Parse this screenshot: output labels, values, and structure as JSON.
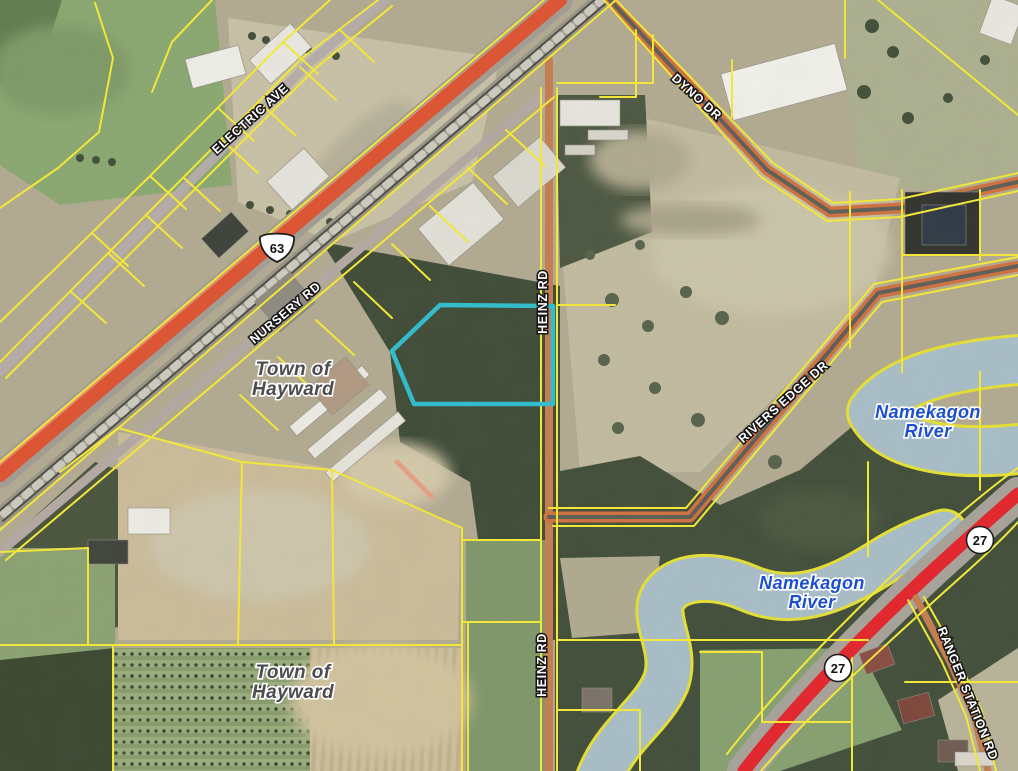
{
  "map": {
    "road_labels": [
      {
        "id": "electric-ave",
        "text": "ELECTRIC AVE"
      },
      {
        "id": "nursery-rd",
        "text": "NURSERY RD"
      },
      {
        "id": "dyno-dr",
        "text": "DYNO DR"
      },
      {
        "id": "heinz-rd-north",
        "text": "HEINZ RD"
      },
      {
        "id": "heinz-rd-south",
        "text": "HEINZ RD"
      },
      {
        "id": "rivers-edge-dr",
        "text": "RIVERS EDGE DR"
      },
      {
        "id": "ranger-station-rd",
        "text": "RANGER STATION RD"
      }
    ],
    "place_labels": [
      {
        "id": "town-of-hayward-north",
        "lines": [
          "Town of",
          "Hayward"
        ]
      },
      {
        "id": "town-of-hayward-south",
        "lines": [
          "Town of",
          "Hayward"
        ]
      }
    ],
    "water_labels": [
      {
        "id": "namekagon-river-upper",
        "lines": [
          "Namekagon",
          "River"
        ]
      },
      {
        "id": "namekagon-river-lower",
        "lines": [
          "Namekagon",
          "River"
        ]
      }
    ],
    "shields": [
      {
        "type": "us-route-shield",
        "number": "63"
      },
      {
        "type": "state-circle-shield",
        "number": "27"
      },
      {
        "type": "state-circle-shield",
        "number": "27"
      }
    ],
    "colors": {
      "parcel_line": "#f2e63a",
      "highlight_parcel": "#35bccb",
      "us63_highway": "#e0512f",
      "state_hwy_27": "#e62129",
      "minor_road": "#c77c4e",
      "water": "#a9bfca",
      "water_label_text": "#1c4fd0",
      "town_label_text": "#4c4c50",
      "road_label_text": "#ffffff"
    }
  }
}
